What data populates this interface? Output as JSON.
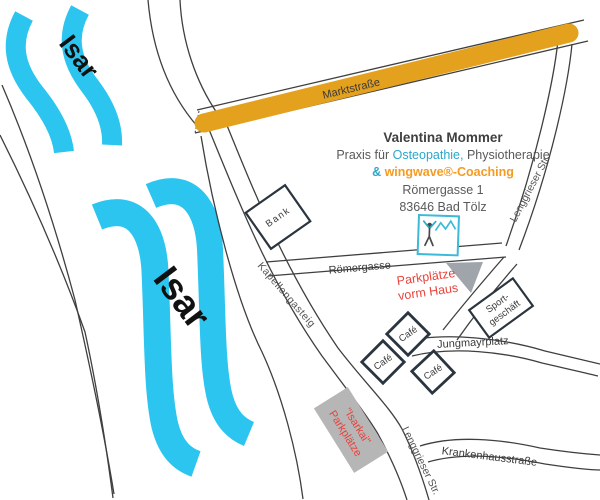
{
  "praxis": {
    "name": "Valentina Mommer",
    "line2_prefix": "Praxis für ",
    "line2_osteopathie": "Osteopathie,",
    "line2_physiotherapie": " Physiotherapie",
    "line3_amp": "& ",
    "line3_wingwave": "wingwave®-Coaching",
    "address_street": "Römergasse 1",
    "address_city": "83646 Bad Tölz"
  },
  "rivers": {
    "upper_label": "Isar",
    "lower_label": "Isar"
  },
  "streets": {
    "marktstrasse": "Marktstraße",
    "roemergasse": "Römergasse",
    "kapellengasteig": "Kapellengasteig",
    "lenggrieser_upper": "Lenggrieser Str.",
    "lenggrieser_lower": "Lenggrieser Str.",
    "krankenhausstrasse": "Krankenhausstraße",
    "jungmayrplatz": "Jungmayrplatz"
  },
  "buildings": {
    "bank": "Bank",
    "cafe_1": "Café",
    "cafe_2": "Café",
    "cafe_3": "Café",
    "sport_line1": "Sport-",
    "sport_line2": "geschäft"
  },
  "parking": {
    "vorm_haus_line1": "Parkplätze",
    "vorm_haus_line2": "vorm Haus",
    "isarkai_line1": "\"Isarkai\"",
    "isarkai_line2": "Parkplätze"
  },
  "colors": {
    "river_cyan": "#2BC5F0",
    "main_road_orange": "#E4A11E",
    "accent_teal": "#2AA7CA",
    "accent_orange": "#F59B22",
    "alert_red": "#E8433C",
    "parking_gray": "#B6B6B6",
    "street_line": "#3F3F3F"
  }
}
